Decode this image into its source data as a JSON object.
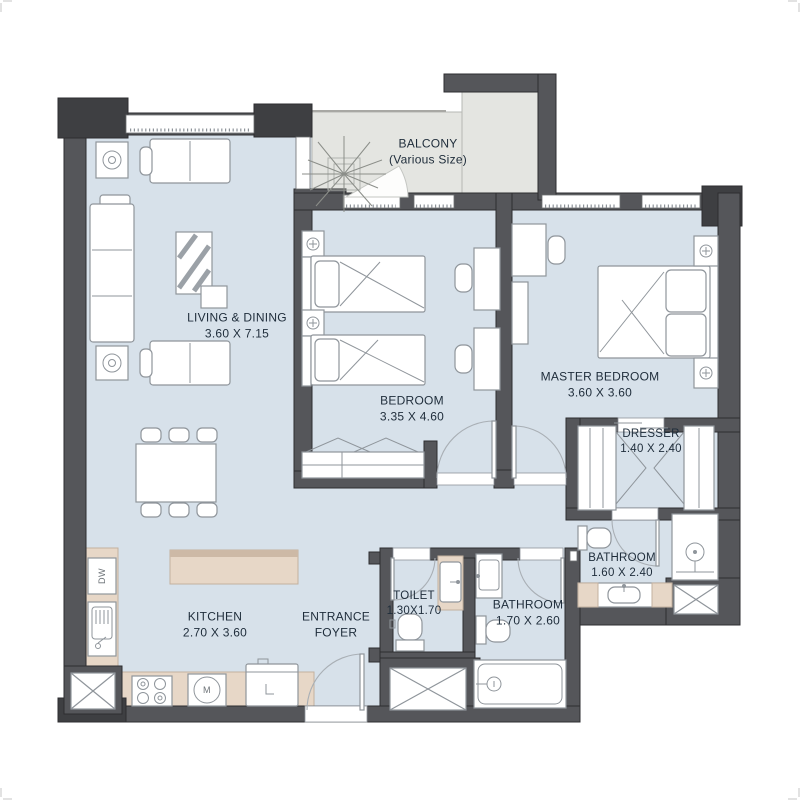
{
  "colors": {
    "floor": "#d7e1ea",
    "balcony-floor": "#e4e5e1",
    "wall": "#55565a",
    "wall-dark": "#3e3f42",
    "counter": "#e7d7c7",
    "counter-edge": "#cdb9a6",
    "furniture-stroke": "#8f959b",
    "arc": "#a9afb5",
    "window": "#ffffff",
    "outline": "#2d2d30",
    "text": "#1e2c3a"
  },
  "balcony": {
    "label": "BALCONY",
    "sublabel": "(Various Size)"
  },
  "rooms": {
    "living": {
      "label": "LIVING & DINING",
      "dims": "3.60 X 7.15"
    },
    "bedroom": {
      "label": "BEDROOM",
      "dims": "3.35 X 4.60"
    },
    "master": {
      "label": "MASTER BEDROOM",
      "dims": "3.60 X 3.60"
    },
    "dresser": {
      "label": "DRESSER",
      "dims": "1.40 X 2.40"
    },
    "master_bath": {
      "label": "BATHROOM",
      "dims": "1.60 X 2.40"
    },
    "toilet": {
      "label": "TOILET",
      "dims": "1.30X1.70"
    },
    "bath": {
      "label": "BATHROOM",
      "dims": "1.70 X 2.60"
    },
    "kitchen": {
      "label": "KITCHEN",
      "dims": "2.70 X 3.60"
    },
    "foyer": {
      "label": "ENTRANCE",
      "label2": "FOYER"
    }
  },
  "appliances": {
    "dishwasher": "DW",
    "washer": "M"
  }
}
